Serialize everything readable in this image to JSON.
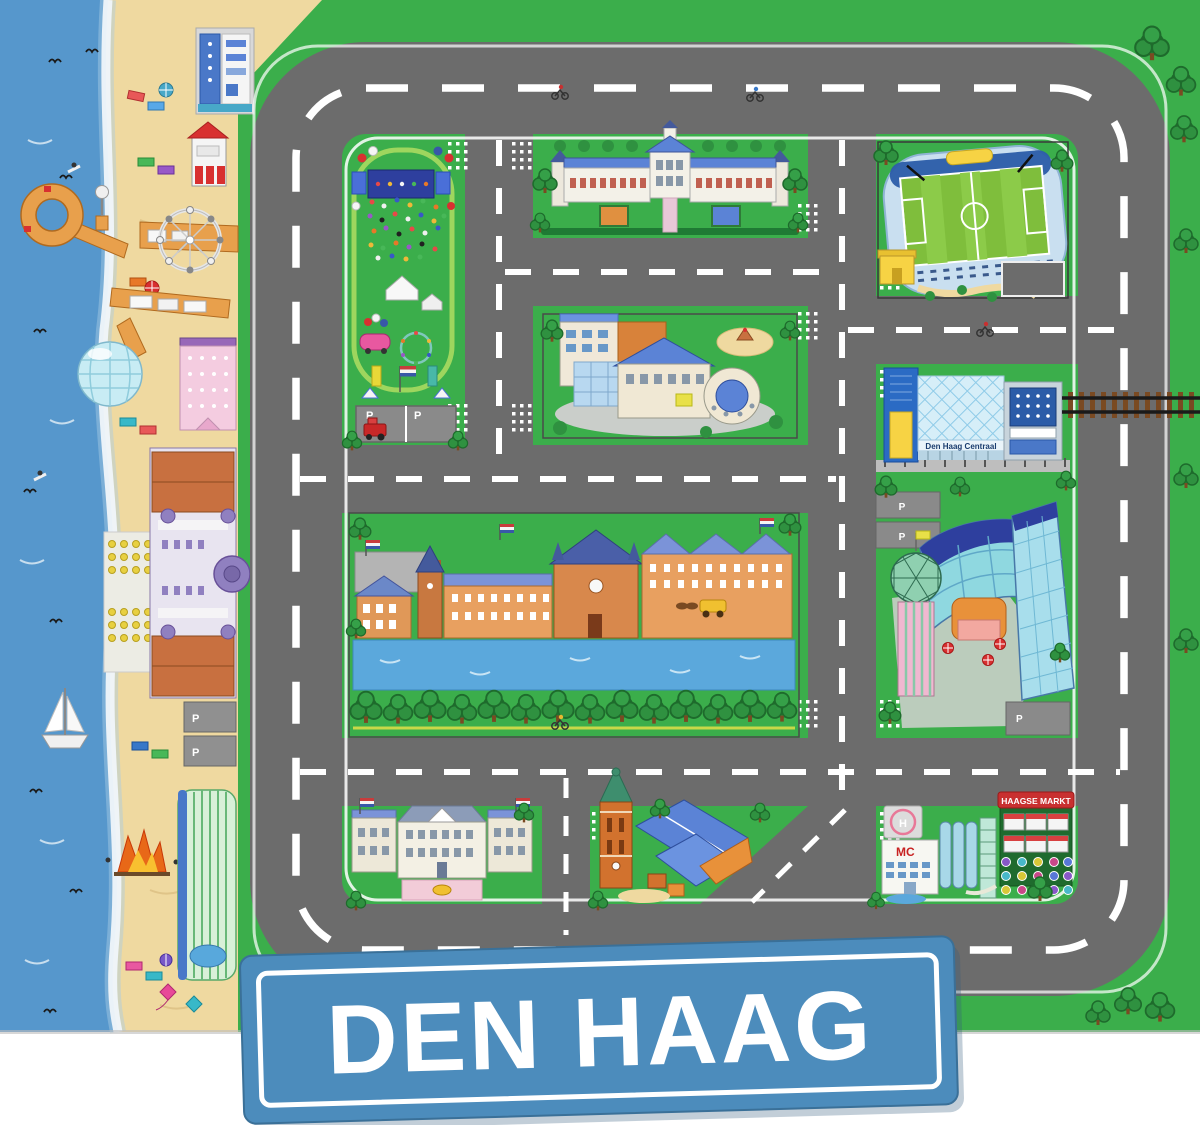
{
  "scene": {
    "type": "toy-city-playmat",
    "city": "Den Haag",
    "description": "Illustrated children's play mat of Den Haag with roads, beach and landmarks"
  },
  "sign": {
    "label": "DEN HAAG",
    "bg_color": "#4C8CBC",
    "border_color": "#FFFFFF",
    "text_color": "#FFFFFF"
  },
  "labels": {
    "station": "Den Haag Centraal",
    "market": "HAAGSE MARKT",
    "hospital": "MC",
    "helipad": "H",
    "parking": "P"
  },
  "landmarks": [
    "sea-and-beach",
    "scheveningen-pier",
    "ferris-wheel",
    "kurhaus-hotel",
    "beach-pavilion",
    "beach-shop",
    "beach-hotel",
    "sailboat",
    "bonfire",
    "festival-park",
    "palace-huis-ten-bosch",
    "football-stadium",
    "museum-theater",
    "den-haag-centraal-station",
    "railway",
    "binnenhof-hofvijver",
    "golden-coach",
    "office-towers",
    "noordeinde-palace",
    "grote-kerk",
    "hospital",
    "haagse-markt",
    "bicycle-parking",
    "den-haag-sign"
  ],
  "colors": {
    "sea": "#5697CC",
    "surf": "#F0F6FA",
    "sand": "#EFD9A0",
    "grass": "#3BAE4B",
    "road": "#6C6C6C",
    "road_marking": "#FFFFFF",
    "tree": "#2F9140",
    "pond": "#5BA8DC",
    "brick": "#D8884C",
    "roof_blue": "#5B83D6",
    "sign_blue": "#4C8CBC"
  }
}
